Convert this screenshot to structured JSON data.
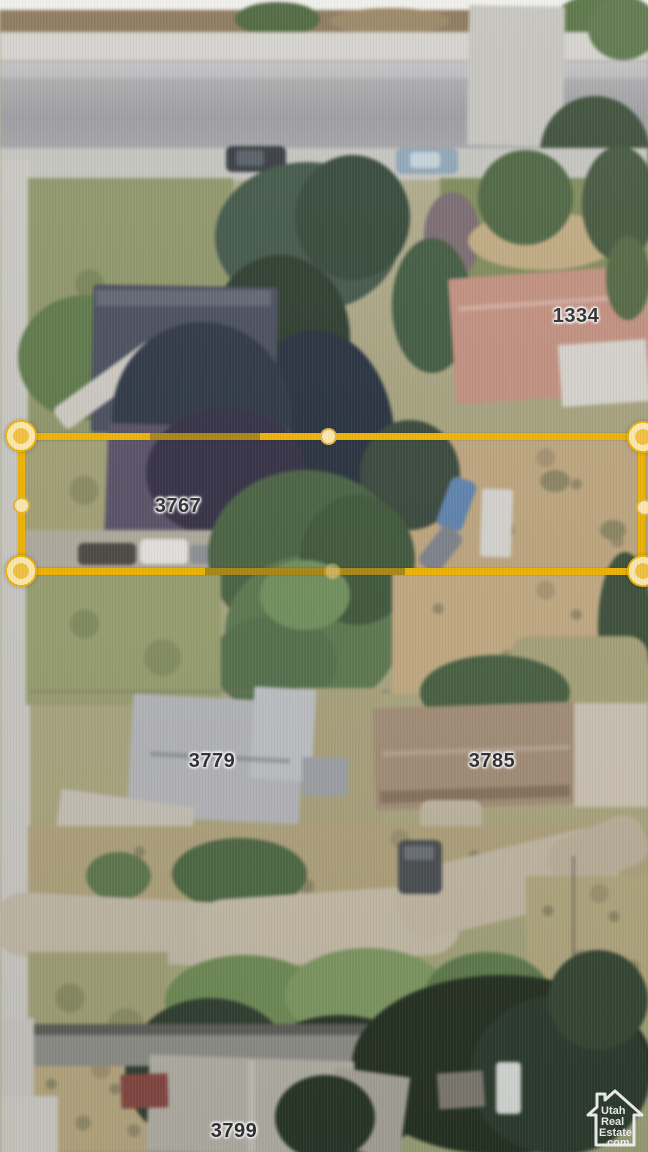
{
  "scene": {
    "description": "Aerial satellite photo of residential lots along a street; middle parcel outlined for sale",
    "parcels": [
      {
        "label": "1334"
      },
      {
        "label": "3767",
        "highlighted": true
      },
      {
        "label": "3779"
      },
      {
        "label": "3785"
      },
      {
        "label": "3799"
      }
    ]
  },
  "boundary": {
    "shape": "rectangle",
    "stroke_color": "#f1b400",
    "vertex_handles": 4,
    "midpoint_handles": 4
  },
  "watermark": {
    "icon": "house-outline-icon",
    "line1": "Utah",
    "line2": "Real",
    "line3": "Estate",
    "line4": ".com"
  },
  "colors": {
    "boundary": "#f1b400",
    "handle_ring": "#ffeab0",
    "handle_core": "#f6c33e",
    "label_text": "#2e2e32",
    "watermark": "#ffffff"
  }
}
